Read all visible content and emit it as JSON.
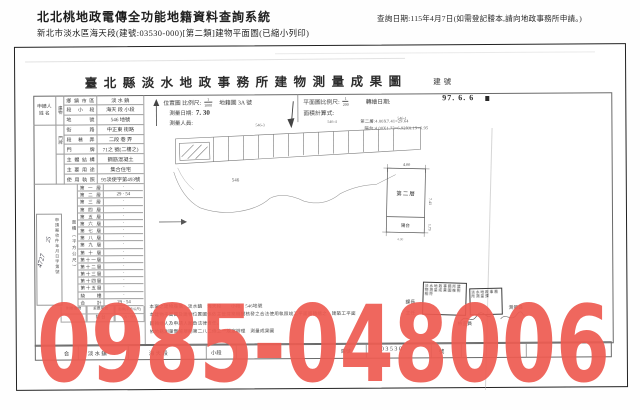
{
  "header": {
    "system_title": "北北桃地政電傳全功能地籍資料查詢系統",
    "query_date": "查詢日期:115年4月7日(如需登記謄本,請向地政事務所申請。)",
    "subtitle": "新北市淡水區海天段(建號:03530-000)[第二類]建物平面圖(已縮小列印)"
  },
  "document": {
    "title": "臺北縣淡水地政事務所建物測量成果圖",
    "building_no_label": "建號",
    "applicant_label": "申請人",
    "applicant_name_label": "姓 名",
    "building_strip": "建物",
    "doorplate_strip": "門牌",
    "info_rows": [
      {
        "label": "鄉鎮市區",
        "value": "淡 水 鎮"
      },
      {
        "label": "段小段",
        "value": "海天 段 小段"
      },
      {
        "label": "地號",
        "value": "546 地號"
      },
      {
        "label": "街路",
        "value": "中正東 街路"
      },
      {
        "label": "段巷弄",
        "value": "二段 巷 弄"
      },
      {
        "label": "門牌",
        "value": "71之 號(二樓之)"
      },
      {
        "label": "主體結構",
        "value": "鋼筋混凝土"
      },
      {
        "label": "主要用途",
        "value": "集合住宅"
      },
      {
        "label": "使用執照",
        "value": "95淡使字第493號"
      }
    ],
    "area_col_label": "面積（平方公尺）",
    "case_box_text": "申請案收件年月日字第號",
    "handwriting_1": "4727",
    "handwriting_2": "25",
    "floors": [
      {
        "label": "第一層",
        "value": "·"
      },
      {
        "label": "第二層",
        "value": "29 · 54"
      },
      {
        "label": "第三層",
        "value": "·"
      },
      {
        "label": "第四層",
        "value": "·"
      },
      {
        "label": "第五層",
        "value": "·"
      },
      {
        "label": "第六層",
        "value": "·"
      },
      {
        "label": "第七層",
        "value": "·"
      },
      {
        "label": "第八層",
        "value": "·"
      },
      {
        "label": "第九層",
        "value": "·"
      },
      {
        "label": "第十層",
        "value": "·"
      },
      {
        "label": "第十一層",
        "value": "·"
      },
      {
        "label": "第十二層",
        "value": "·"
      },
      {
        "label": "第十三層",
        "value": "·"
      },
      {
        "label": "第十四層",
        "value": "·"
      },
      {
        "label": "第十五層",
        "value": "·"
      },
      {
        "label": "騎樓",
        "value": "·"
      },
      {
        "label": "合計",
        "value": "29 · 54"
      }
    ],
    "annex": {
      "h1": "附屬建物",
      "h2": "主要用途",
      "h3": "面積(平方公尺)",
      "use": "陽 台",
      "area": "6 · 95"
    },
    "location": {
      "scale_label": "位置圖 比例尺:",
      "scale_num": "1",
      "scale_den": "1000",
      "sheet": "地籍圖 3A 號",
      "survey_date_label": "測量日期:",
      "survey_date": "7. 30",
      "surveyor_label": "測量人員:",
      "parcels": [
        "546-3",
        "546-4",
        "546-1",
        "546"
      ]
    },
    "plan": {
      "scale_label": "平面圖比例尺:",
      "scale_num": "1",
      "scale_den": "200",
      "redraw_label": "轉繪日期:",
      "redraw_date": "97. 6. 6",
      "calc_label": "面積計算式:",
      "calc1": "第二層:4.00X7.41=29.64",
      "calc2": "陽台:4.00X1.73=6.92X0.19=6.95",
      "floorplan": {
        "dim_top": "4.00",
        "room": "第二層",
        "dim_right": "7.41",
        "balcony": "陽台",
        "dim_balcony": "1.73",
        "dim_bottom": "4.00"
      }
    },
    "cert_lines": [
      "本案之建物座落　淡水鎮　海天段　　小段　546地號",
      "本建物平面圖及建物位置圖係依主管建築機關核發之合法使用執照竣工平面圖轉繪之　建築工平面",
      "圖轉繪人及申請人願負法律責任。",
      "依地籍測量實施規則第二八二條之一規定辦理　測量成果圖"
    ],
    "signatures": [
      "課長",
      "主任",
      "檢查員",
      "測量員"
    ],
    "stamps": [
      "淡水地政事務所建物測量成果圖核對相符",
      "淡水地政事務所測量課"
    ],
    "bottom_cells": [
      "合",
      "淡 水 鎮",
      "海 天 段",
      "小段",
      "建號",
      "0 3 5 3 0",
      "號"
    ]
  },
  "overlay": {
    "phone": "0985-048006",
    "color": "#ee5b51"
  }
}
